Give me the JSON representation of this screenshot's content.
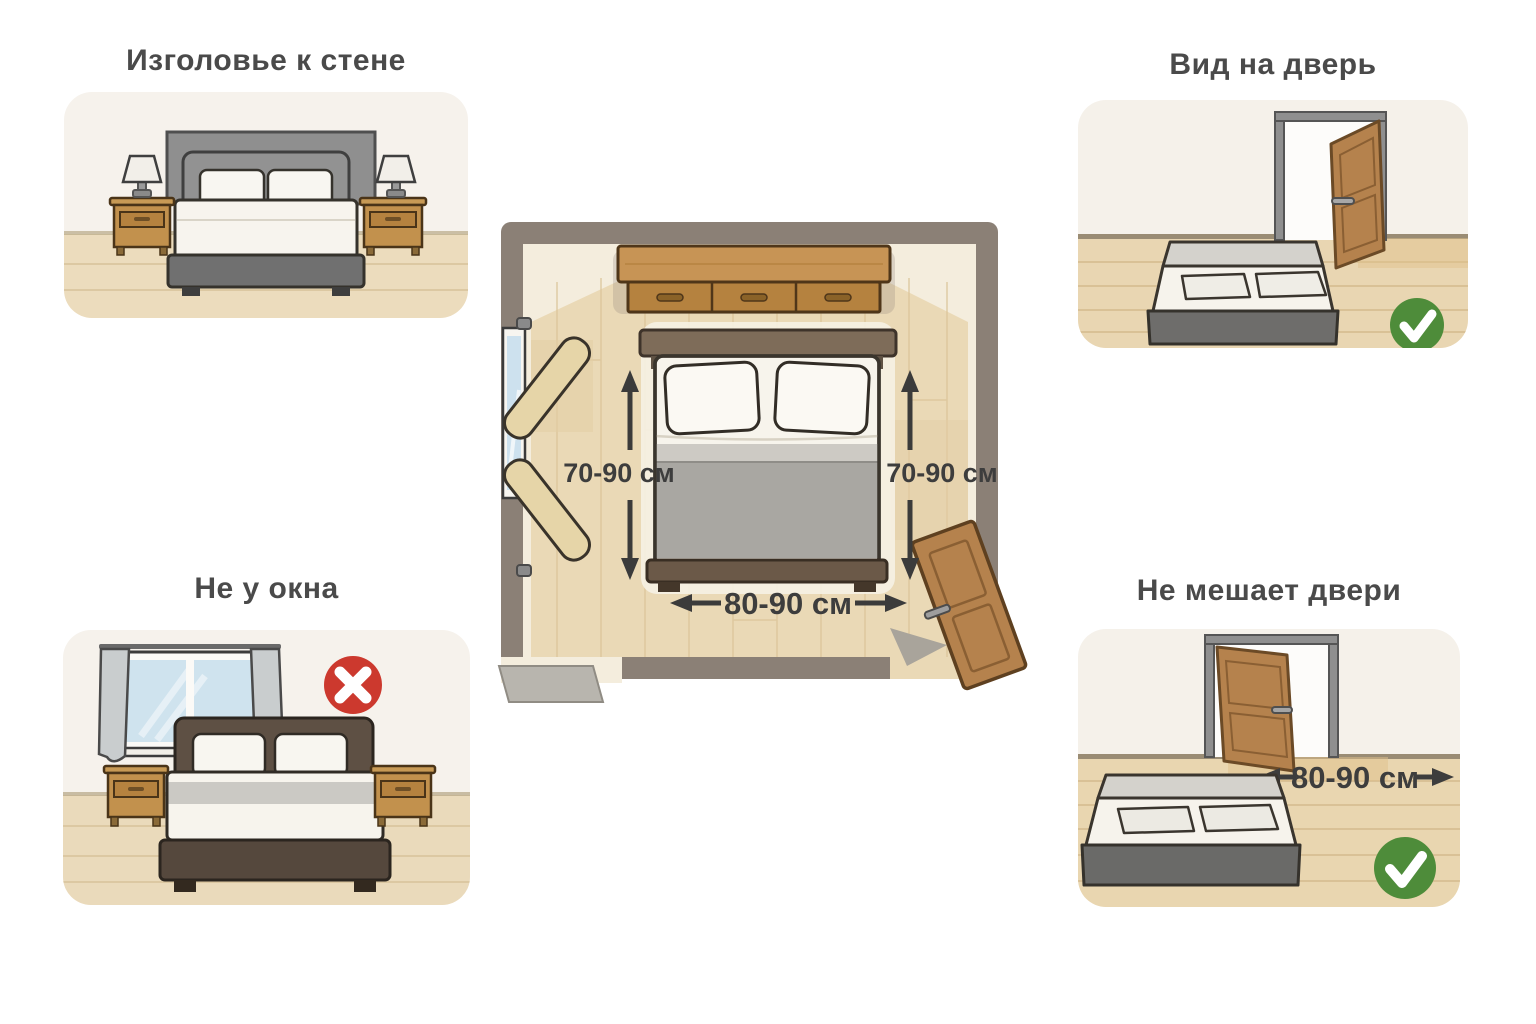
{
  "infographic": {
    "panels": {
      "headboard_wall": {
        "title": "Изголовье к стене"
      },
      "door_view": {
        "title": "Вид на дверь",
        "status_icon": "checkmark"
      },
      "not_by_window": {
        "title": "Не у окна",
        "status_icon": "cross"
      },
      "not_blocking_door": {
        "title": "Не мешает двери",
        "status_icon": "checkmark",
        "door_clearance": "80-90 см"
      }
    },
    "floorplan": {
      "left_side_clearance": "70-90 см",
      "right_side_clearance": "70-90 см",
      "foot_clearance": "80-90 см"
    },
    "colors": {
      "approve_green": "#4e8c3a",
      "reject_red": "#cc392e",
      "wall_taupe": "#8b8076",
      "door_wood": "#b5824d",
      "label_text": "#3d3d3d"
    }
  }
}
